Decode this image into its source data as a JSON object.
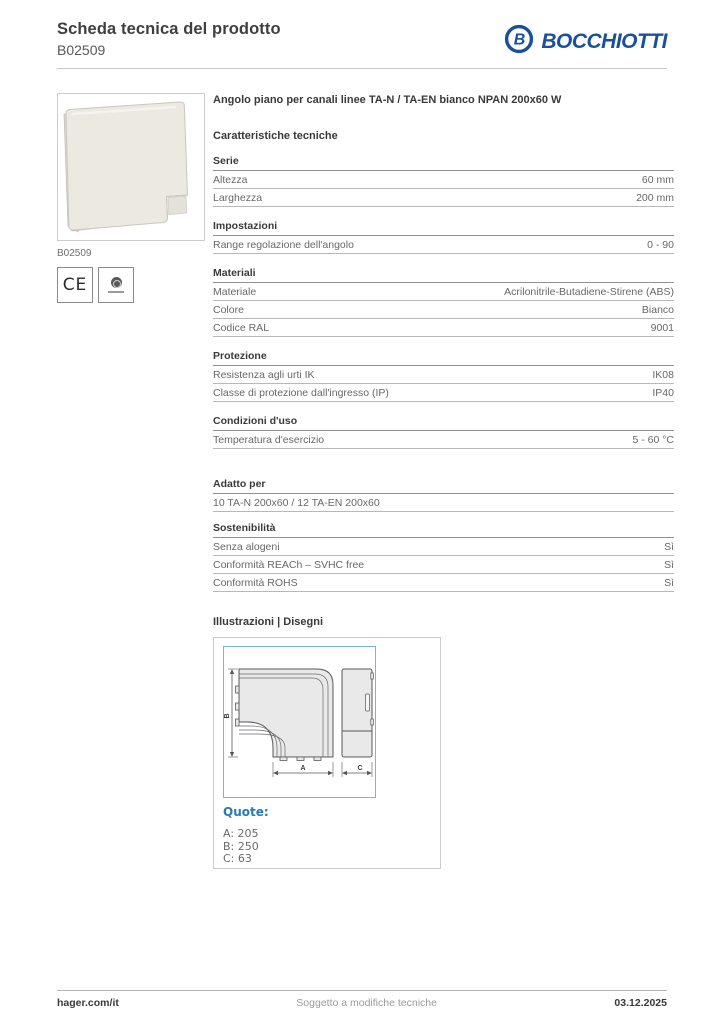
{
  "header": {
    "title": "Scheda tecnica del prodotto",
    "code": "B02509",
    "brand": "BOCCHIOTTI"
  },
  "colors": {
    "brand_blue": "#1a4f9c",
    "drawing_frame_blue": "#79b5d6",
    "quote_blue": "#2779b8",
    "rule_gray": "#c6c6c6",
    "text_gray": "#686868"
  },
  "left_panel": {
    "image_caption": "B02509",
    "ce_mark": "CE"
  },
  "product_title": "Angolo piano per canali linee TA-N / TA-EN bianco NPAN 200x60 W",
  "specs": {
    "heading": "Caratteristiche tecniche",
    "sections": [
      {
        "title": "Serie",
        "rows": [
          {
            "label": "Altezza",
            "value": "60 mm"
          },
          {
            "label": "Larghezza",
            "value": "200 mm"
          }
        ]
      },
      {
        "title": "Impostazioni",
        "rows": [
          {
            "label": "Range regolazione dell'angolo",
            "value": "0 - 90"
          }
        ]
      },
      {
        "title": "Materiali",
        "rows": [
          {
            "label": "Materiale",
            "value": "Acrilonitrile-Butadiene-Stirene (ABS)"
          },
          {
            "label": "Colore",
            "value": "Bianco"
          },
          {
            "label": "Codice RAL",
            "value": "9001"
          }
        ]
      },
      {
        "title": "Protezione",
        "rows": [
          {
            "label": "Resistenza agli urti IK",
            "value": "IK08"
          },
          {
            "label": "Classe di protezione dall'ingresso (IP)",
            "value": "IP40"
          }
        ]
      },
      {
        "title": "Condizioni d'uso",
        "rows": [
          {
            "label": "Temperatura d'esercizio",
            "value": "5 - 60 °C"
          }
        ]
      },
      {
        "title": "Adatto per",
        "rows": [
          {
            "label": "10 TA-N 200x60 / 12 TA-EN 200x60",
            "value": ""
          }
        ]
      },
      {
        "title": "Sostenibilità",
        "rows": [
          {
            "label": "Senza alogeni",
            "value": "Sì"
          },
          {
            "label": "Conformità REACh – SVHC free",
            "value": "Sì"
          },
          {
            "label": "Conformità ROHS",
            "value": "Sì"
          }
        ]
      }
    ]
  },
  "illustrations": {
    "heading": "Illustrazioni | Disegni",
    "quote_label": "Quote:",
    "dimensions": [
      {
        "label": "A",
        "value": "205"
      },
      {
        "label": "B",
        "value": "250"
      },
      {
        "label": "C",
        "value": "63"
      }
    ]
  },
  "footer": {
    "website": "hager.com/it",
    "note": "Soggetto a modifiche tecniche",
    "date": "03.12.2025"
  }
}
